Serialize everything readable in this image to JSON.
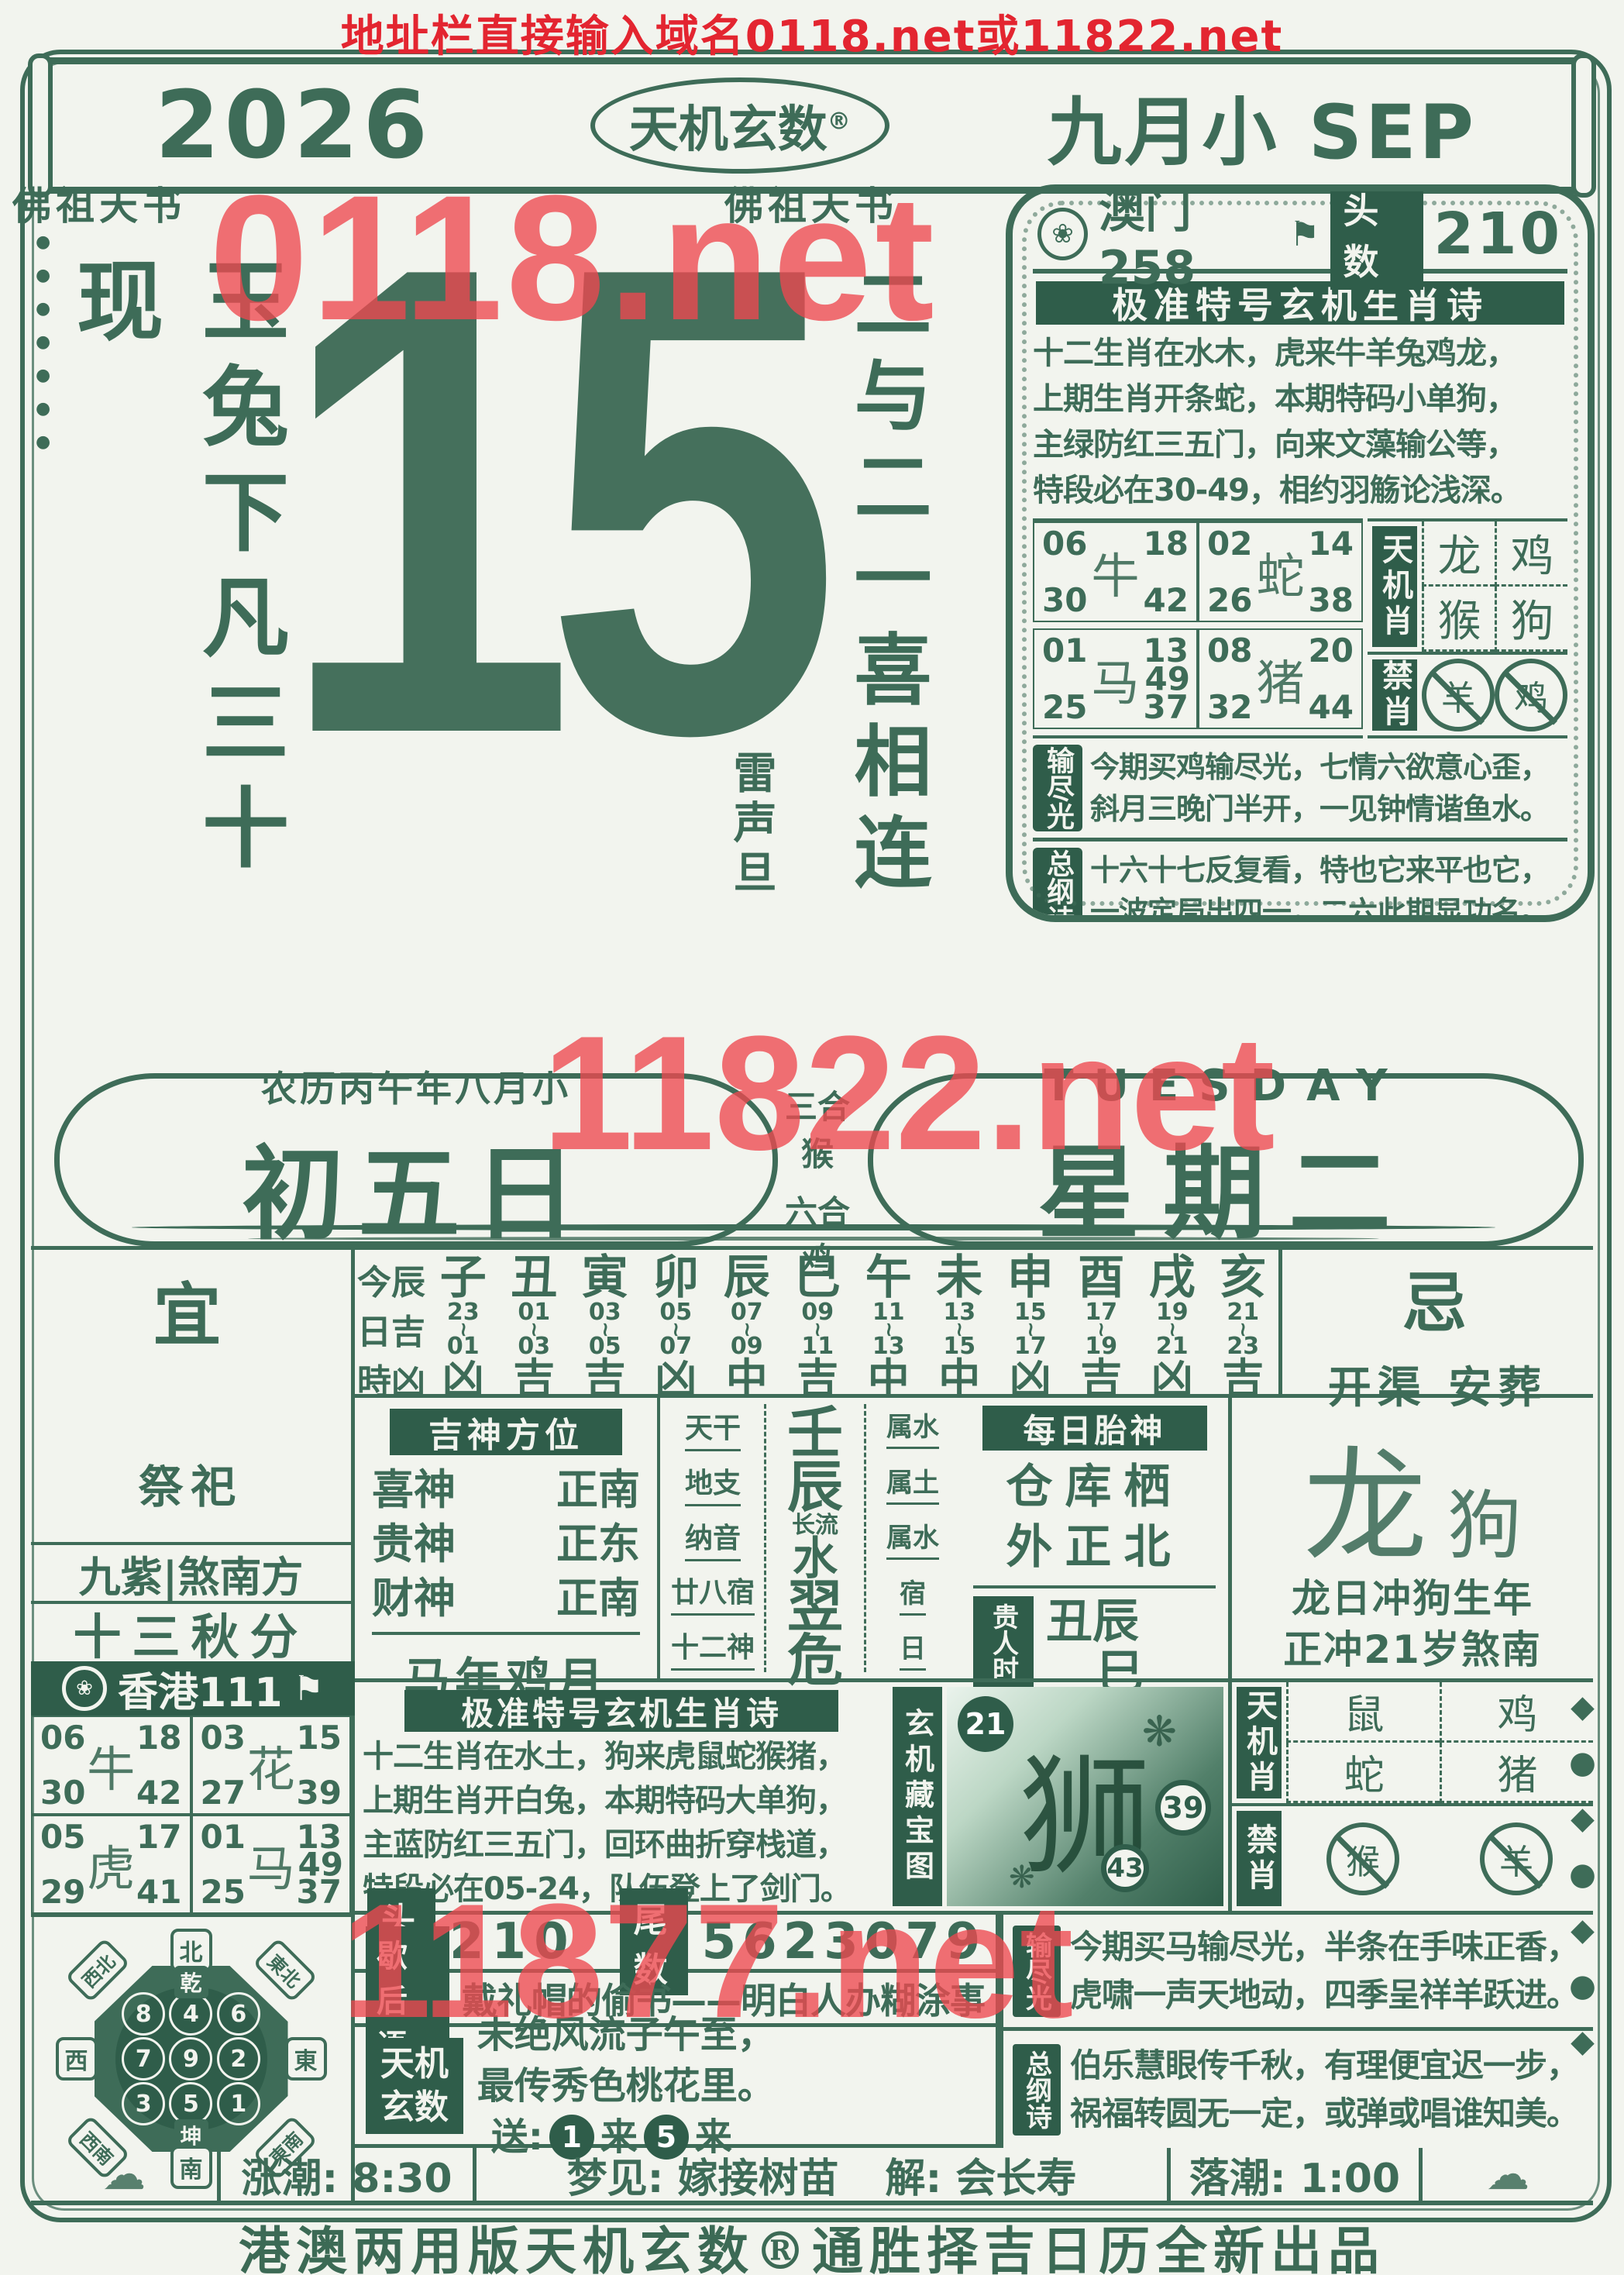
{
  "page": {
    "top_line": "地址栏直接输入域名0118.net或11822.net",
    "watermarks": {
      "top": "0118.net",
      "middle": "11822.net",
      "bottom": "11877.net"
    },
    "footer": "港澳两用版天机玄数®通胜择吉日历全新出品",
    "colors": {
      "ink": "#3e6c58",
      "dark_fill": "#2f5d4a",
      "paper": "#f2f4ee",
      "red": "#e32530",
      "watermark_red": "#ee4850"
    }
  },
  "header": {
    "year": "2026",
    "brand": "天机玄数",
    "reg_mark": "®",
    "month": "九月小 SEP"
  },
  "masthead": {
    "left_label": "佛祖天书",
    "center_label": "佛祖天书",
    "left_calligraphy": "玉兔下凡三十现",
    "day_number": "15",
    "right_calligraphy": "二与二一喜相连",
    "right_note": "雷声旦"
  },
  "macau_box": {
    "emblem": "❀",
    "source": "澳门258",
    "flag": "⚑",
    "head_label": "头数",
    "head_value": "210",
    "poem_title": "极准特号玄机生肖诗",
    "poem_lines": [
      "十二生肖在水木，虎来牛羊兔鸡龙，",
      "上期生肖开条蛇，本期特码小单狗，",
      "主绿防红三五门，向来文藻输公等，",
      "特段必在30-49，相约羽觞论浅深。"
    ],
    "grid": {
      "cell1": {
        "animal": "牛",
        "n1": "06",
        "n2": "18",
        "n3": "30",
        "n4": "42"
      },
      "cell2": {
        "animal": "蛇",
        "n1": "02",
        "n2": "14",
        "n3": "26",
        "n4": "38"
      },
      "cell3": {
        "animal": "马",
        "extra": "49",
        "n1": "01",
        "n2": "13",
        "n3": "25",
        "n4": "37"
      },
      "cell4": {
        "animal": "猪",
        "n1": "08",
        "n2": "20",
        "n3": "32",
        "n4": "44"
      }
    },
    "tianjixiao": {
      "label": "天机肖",
      "a1": "龙",
      "a2": "鸡",
      "a3": "猴",
      "a4": "狗"
    },
    "jinxiao": {
      "label": "禁肖",
      "a1": "羊",
      "a2": "鸡"
    },
    "shujinguang": {
      "label": "输尽光",
      "lines": [
        "今期买鸡输尽光，七情六欲意心歪，",
        "斜月三晚门半开，一见钟情谐鱼水。"
      ]
    },
    "zonggangshi": {
      "label": "总纲诗",
      "lines": [
        "十六十七反复看，特也它来平也它，",
        "一波定局出四一，二六此期显功名。"
      ]
    },
    "tail_label": "尾数",
    "tail_value": "5623079"
  },
  "mid_banner": {
    "lunar": "农历丙午年八月小",
    "lunar_day": "初五日",
    "sanhe_label": "三合",
    "sanhe_animal": "猴",
    "liuhe_label": "六合",
    "liuhe_animal": "鸡",
    "weekday_en": "TUESDAY",
    "weekday_cn": "星期二"
  },
  "main": {
    "yi": {
      "label": "宜",
      "content": "祭祀"
    },
    "ji": {
      "label": "忌",
      "content": "开渠 安葬"
    },
    "hours": {
      "row_label1": "今辰",
      "row_label2": "日吉",
      "row_label3": "時凶",
      "sep": "~",
      "columns": [
        {
          "b": "子",
          "s": "23",
          "e": "01",
          "l": "凶"
        },
        {
          "b": "丑",
          "s": "01",
          "e": "03",
          "l": "吉"
        },
        {
          "b": "寅",
          "s": "03",
          "e": "05",
          "l": "吉"
        },
        {
          "b": "卯",
          "s": "05",
          "e": "07",
          "l": "凶"
        },
        {
          "b": "辰",
          "s": "07",
          "e": "09",
          "l": "中"
        },
        {
          "b": "巳",
          "s": "09",
          "e": "11",
          "l": "吉"
        },
        {
          "b": "午",
          "s": "11",
          "e": "13",
          "l": "中"
        },
        {
          "b": "未",
          "s": "13",
          "e": "15",
          "l": "中"
        },
        {
          "b": "申",
          "s": "15",
          "e": "17",
          "l": "凶"
        },
        {
          "b": "酉",
          "s": "17",
          "e": "19",
          "l": "吉"
        },
        {
          "b": "戌",
          "s": "19",
          "e": "21",
          "l": "凶"
        },
        {
          "b": "亥",
          "s": "21",
          "e": "23",
          "l": "吉"
        }
      ]
    },
    "left_info": {
      "line1": "九紫|煞南方",
      "line2": "十三秋分",
      "hk_emblem": "❀",
      "hk_label": "香港111",
      "hk_flag": "⚑"
    },
    "jishen": {
      "title": "吉神方位",
      "r1n": "喜神",
      "r1d": "正南",
      "r2n": "贵神",
      "r2d": "正东",
      "r3n": "财神",
      "r3d": "正南",
      "bottom": "马年鸡月"
    },
    "ganzhi": {
      "l1": "天干",
      "l2": "地支",
      "l3": "纳音",
      "l4": "廿八宿",
      "l5": "十二神",
      "v1": "壬",
      "v2": "辰",
      "v3a": "长流",
      "v3b": "水",
      "v4": "翌",
      "v5": "危",
      "a1": "属水",
      "a2": "属土",
      "a3": "属水",
      "a4": "宿",
      "a5": "日"
    },
    "taishen": {
      "title": "每日胎神",
      "line1": "仓库栖",
      "line2": "外正北",
      "guiren_label": "贵人时",
      "guiren_line1": "丑辰",
      "guiren_line2": "巳"
    },
    "chong": {
      "animal_main": "龙",
      "animal_minor": "狗",
      "line1": "龙日冲狗生年",
      "line2": "正冲21岁煞南"
    },
    "lower_grid": {
      "cell1": {
        "animal": "牛",
        "n1": "06",
        "n2": "18",
        "n3": "30",
        "n4": "42"
      },
      "cell2": {
        "animal": "花",
        "n1": "03",
        "n2": "15",
        "n3": "27",
        "n4": "39"
      },
      "cell3": {
        "animal": "虎",
        "n1": "05",
        "n2": "17",
        "n3": "29",
        "n4": "41"
      },
      "cell4": {
        "animal": "马",
        "extra": "49",
        "n1": "01",
        "n2": "13",
        "n3": "25",
        "n4": "37"
      }
    },
    "poem2": {
      "title": "极准特号玄机生肖诗",
      "lines": [
        "十二生肖在水土，狗来虎鼠蛇猴猪，",
        "上期生肖开白兔，本期特码大单狗，",
        "主蓝防红三五门，回环曲折穿栈道，",
        "特段必在05-24，队伍登上了剑门。"
      ]
    },
    "cangbao": {
      "label": "玄机藏宝图",
      "animal": "狮",
      "num1": "21",
      "num2": "39",
      "num3": "43",
      "leaf": "❋"
    },
    "tianjixiao2": {
      "label": "天机肖",
      "a1": "鼠",
      "a2": "鸡",
      "a3": "蛇",
      "a4": "猪"
    },
    "jinxiao2": {
      "label": "禁肖",
      "a1": "猴",
      "a2": "羊"
    },
    "toushu": {
      "label": "头数",
      "value": "210"
    },
    "weishu": {
      "label": "尾数",
      "value": "5623079"
    },
    "xiehouyu": {
      "label": "歇后语",
      "text": "戴礼帽的偷书——明白人办糊涂事"
    },
    "tianjixuanshu": {
      "label1": "天机",
      "label2": "玄数",
      "line1": "未绝风流子午至，",
      "line2": "最传秀色桃花里。",
      "send": "送:",
      "num1": "1",
      "lai1": "来",
      "num2": "5",
      "lai2": "来"
    },
    "shujinguang2": {
      "label": "输尽光",
      "lines": [
        "今期买马输尽光，半条在手味正香，",
        "虎啸一声天地动，四季呈祥羊跃进。"
      ]
    },
    "zonggangshi2": {
      "label": "总纲诗",
      "lines": [
        "伯乐慧眼传千秋，有理便宜迟一步，",
        "祸福转圆无一定，或弹或唱谁知美。"
      ]
    },
    "tides": {
      "rising": "涨潮: 8:30",
      "dream": "梦见: 嫁接树苗",
      "jie": "解: 会长寿",
      "falling": "落潮: 1:00"
    },
    "compass": {
      "n": "北",
      "s": "南",
      "w": "西",
      "e": "東",
      "nw": "西北",
      "ne": "東北",
      "sw": "西南",
      "se": "東南",
      "trigram_top": "乾",
      "trigram_bottom": "坤",
      "square": [
        "8",
        "4",
        "6",
        "7",
        "9",
        "2",
        "3",
        "5",
        "1"
      ]
    }
  }
}
